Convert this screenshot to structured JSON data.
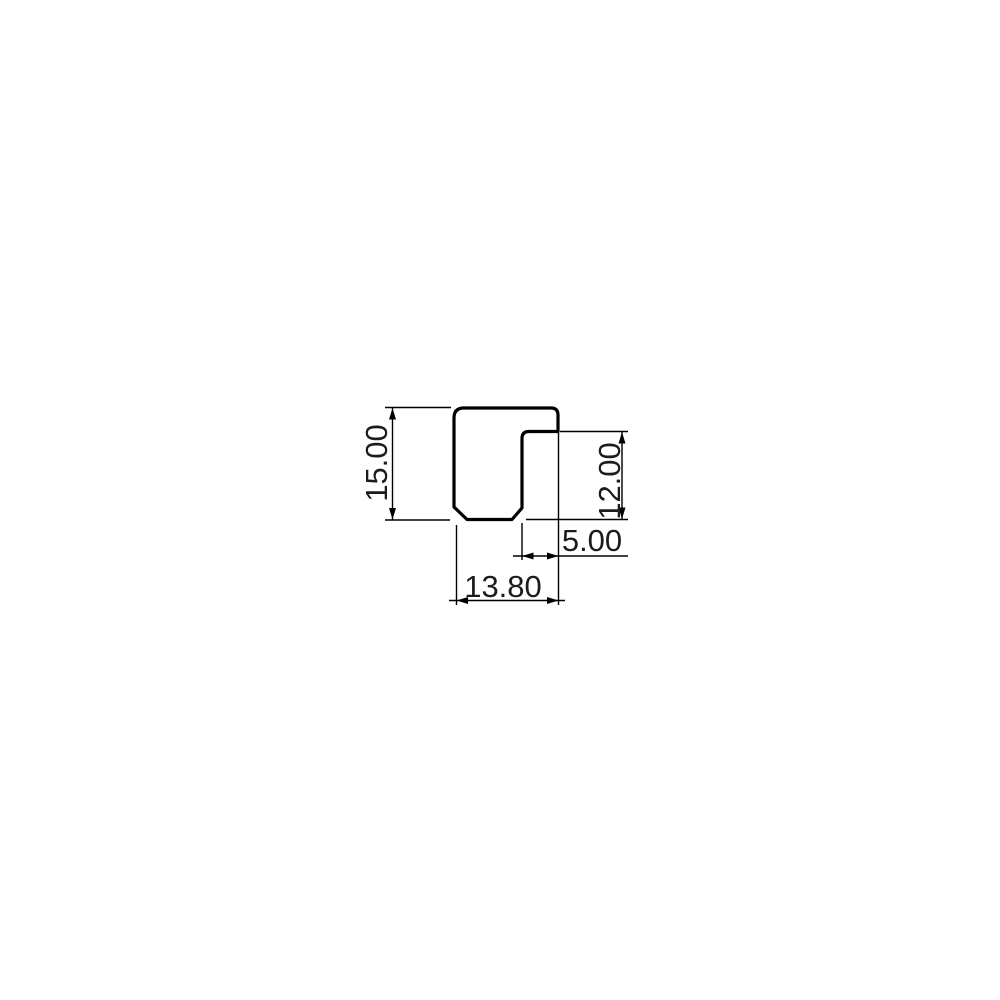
{
  "page": {
    "background_color": "#ffffff"
  },
  "drawing": {
    "kind": "profile-cross-section-technical-drawing",
    "line_color": "#000000",
    "label_color": "#1c1c1c",
    "profile": {
      "shape": "stepped U/J profile with rounded top corners and chamfered bottom corners"
    },
    "dimensions": {
      "overall_height": {
        "label": "15.00",
        "value": 15.0
      },
      "right_height": {
        "label": "12.00",
        "value": 12.0
      },
      "step_width": {
        "label": "5.00",
        "value": 5.0
      },
      "overall_width": {
        "label": "13.80",
        "value": 13.8
      }
    }
  }
}
